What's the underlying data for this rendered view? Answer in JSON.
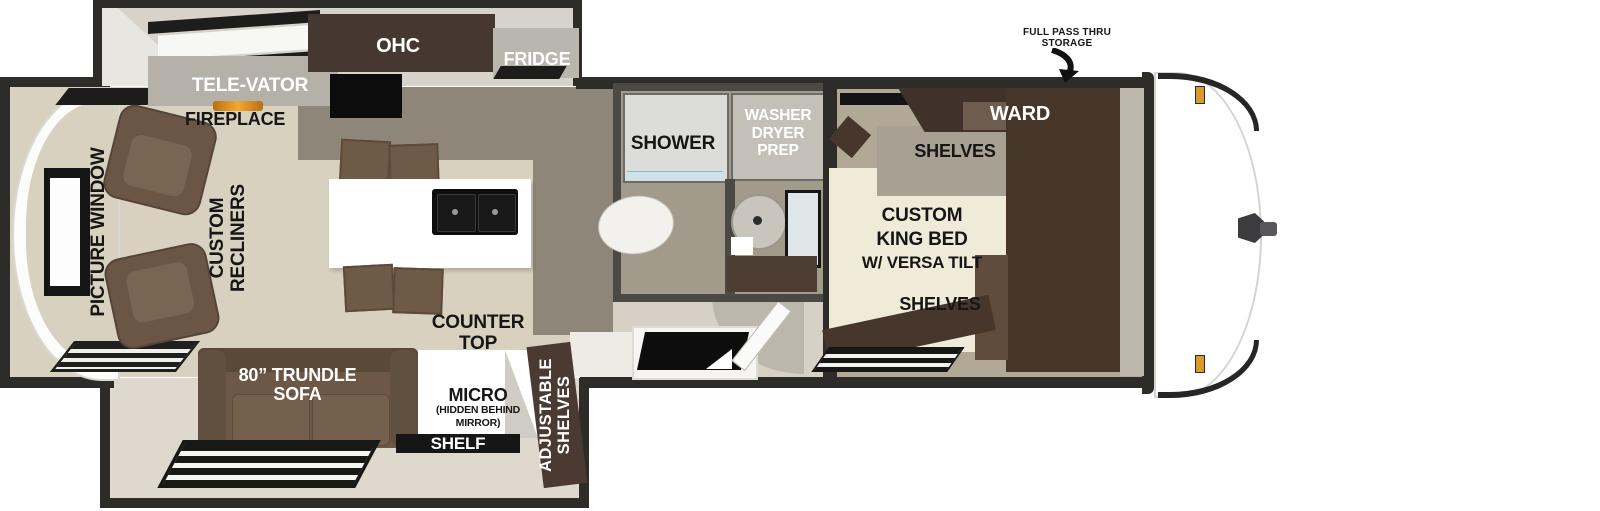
{
  "title": "Travel trailer floor plan",
  "colors": {
    "wall": "#2e2c29",
    "floor_living": "#d8d1bf",
    "floor_kitchen": "#8e8779",
    "floor_bedroom": "#b1a895",
    "floor_bath": "#a29b8c",
    "cabinet_dark": "#46362c",
    "sofa_brown": "#6d5847",
    "island_white": "#ffffff",
    "marker_amber": "#d99a2b"
  },
  "labels": {
    "storage_note": {
      "line1": "FULL PASS THRU",
      "line2": "STORAGE"
    },
    "ohc": "OHC",
    "fridge": "FRIDGE",
    "televator": "TELE-VATOR",
    "fireplace": "FIREPLACE",
    "picture_window": "PICTURE WINDOW",
    "recliners": {
      "line1": "CUSTOM",
      "line2": "RECLINERS"
    },
    "shower": "SHOWER",
    "washer_dryer": {
      "line1": "WASHER",
      "line2": "DRYER",
      "line3": "PREP"
    },
    "ward": "WARD",
    "shelves_head": "SHELVES",
    "king_bed": {
      "line1": "CUSTOM",
      "line2": "KING BED",
      "line3": "W/ VERSA TILT"
    },
    "shelves_foot": "SHELVES",
    "counter_top": {
      "line1": "COUNTER",
      "line2": "TOP"
    },
    "trundle_sofa": {
      "line1": "80” TRUNDLE",
      "line2": "SOFA"
    },
    "micro": {
      "line1": "MICRO",
      "line2": "(HIDDEN BEHIND",
      "line3": "MIRROR)"
    },
    "shelf": "SHELF",
    "adjustable_shelves": {
      "line1": "ADJUSTABLE",
      "line2": "SHELVES"
    }
  }
}
